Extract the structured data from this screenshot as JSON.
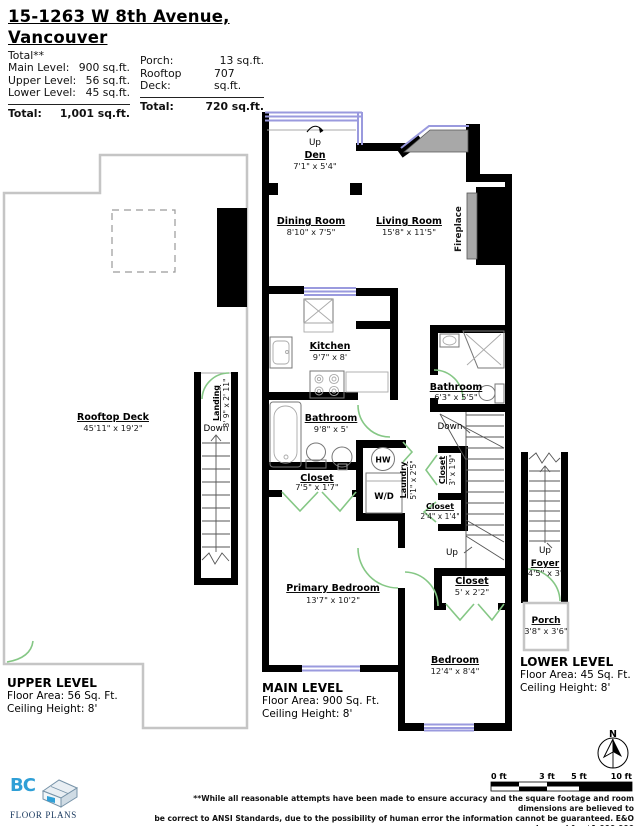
{
  "header": {
    "title_line1": "15-1263 W 8th Avenue,",
    "title_line2": "Vancouver",
    "total_note": "Total**",
    "left_rows": [
      {
        "label": "Main Level:",
        "value": "900 sq.ft."
      },
      {
        "label": "Upper Level:",
        "value": "56 sq.ft."
      },
      {
        "label": "Lower Level:",
        "value": "45 sq.ft."
      }
    ],
    "left_total_label": "Total:",
    "left_total_value": "1,001 sq.ft.",
    "right_rows": [
      {
        "label": "Porch:",
        "value": "13 sq.ft."
      },
      {
        "label": "Rooftop Deck:",
        "value": "707 sq.ft."
      }
    ],
    "right_total_label": "Total:",
    "right_total_value": "720 sq.ft."
  },
  "rooms": {
    "den": {
      "name": "Den",
      "dims": "7'1\" x 5'4\""
    },
    "dining_room": {
      "name": "Dining Room",
      "dims": "8'10\" x 7'5\""
    },
    "living_room": {
      "name": "Living Room",
      "dims": "15'8\" x 11'5\""
    },
    "fireplace": {
      "name": "Fireplace"
    },
    "kitchen": {
      "name": "Kitchen",
      "dims": "9'7\" x 8'"
    },
    "bathroom_main": {
      "name": "Bathroom",
      "dims": "9'8\" x 5'"
    },
    "bathroom_upper": {
      "name": "Bathroom",
      "dims": "6'3\" x 5'5\""
    },
    "closet_hall": {
      "name": "Closet",
      "dims": "7'5\" x 1'7\""
    },
    "laundry": {
      "name": "Laundry",
      "dims": "5'1\" x 2'5\""
    },
    "closet_stairs": {
      "name": "Closet",
      "dims": "3' x 1'9\""
    },
    "closet_small": {
      "name": "Closet",
      "dims": "2'4\" x 1'4\""
    },
    "closet_bedroom": {
      "name": "Closet",
      "dims": "5' x 2'2\""
    },
    "primary_bedroom": {
      "name": "Primary Bedroom",
      "dims": "13'7\" x 10'2\""
    },
    "bedroom": {
      "name": "Bedroom",
      "dims": "12'4\" x 8'4\""
    },
    "rooftop_deck": {
      "name": "Rooftop Deck",
      "dims": "45'11\" x 19'2\""
    },
    "landing": {
      "name": "Landing",
      "dims": "3' 9\" x 2' 11\""
    },
    "foyer": {
      "name": "Foyer",
      "dims": "4'5\" x 3'"
    },
    "porch": {
      "name": "Porch",
      "dims": "3'8\" x 3'6\""
    }
  },
  "fixtures": {
    "hot_water": "HW",
    "washer_dryer": "W/D"
  },
  "annotations": {
    "up_den": "Up",
    "down_landing": "Down",
    "down_stairs": "Down",
    "up_stairs": "Up",
    "up_foyer": "Up"
  },
  "levels": {
    "upper": {
      "title": "UPPER LEVEL",
      "area": "Floor Area: 56 Sq. Ft.",
      "ceiling": "Ceiling Height: 8'"
    },
    "main": {
      "title": "MAIN LEVEL",
      "area": "Floor Area: 900 Sq. Ft.",
      "ceiling": "Ceiling Height: 8'"
    },
    "lower": {
      "title": "LOWER LEVEL",
      "area": "Floor Area: 45 Sq. Ft.",
      "ceiling": "Ceiling Height: 8'"
    }
  },
  "compass": {
    "label": "N"
  },
  "scale_bar": {
    "labels": [
      "0 ft",
      "3 ft",
      "5 ft",
      "10 ft"
    ]
  },
  "footer": {
    "logo_text": "BC",
    "logo_subtext": "FLOOR PLANS",
    "disclaimer_line1": "**While all reasonable attempts have been made to ensure accuracy and the square footage and room dimensions are believed to",
    "disclaimer_line2": "be correct to ANSI Standards, due to the possibility of human error the information cannot be guaranteed. E&O Insured for $1,000,000",
    "disclaimer_line3": "** May Include Unfinished areas"
  },
  "colors": {
    "wall": "#000000",
    "window": "#9a9ade",
    "door": "#85c785",
    "bay_fill": "#a8a8a8",
    "deck_outline": "#c5c5c5",
    "logo_blue": "#2f9fd6",
    "logo_navy": "#16365c"
  }
}
